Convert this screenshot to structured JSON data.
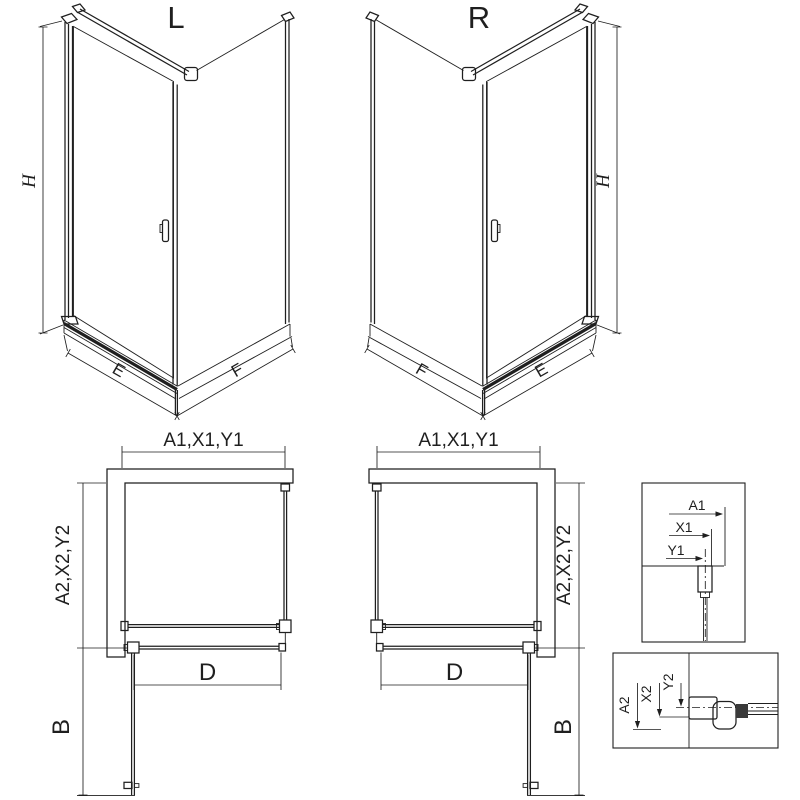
{
  "colors": {
    "ink": "#1f1f1f",
    "background": "#ffffff"
  },
  "views": {
    "iso_left": {
      "label": "L",
      "height_dim": "H",
      "front_dim": "E",
      "side_dim": "F"
    },
    "iso_right": {
      "label": "R",
      "height_dim": "H",
      "front_dim": "E",
      "side_dim": "F"
    },
    "plan_left": {
      "width_dim": "A1,X1,Y1",
      "depth_dim": "A2,X2,Y2",
      "door_dim": "D",
      "swing_dim": "B"
    },
    "plan_right": {
      "width_dim": "A1,X1,Y1",
      "depth_dim": "A2,X2,Y2",
      "door_dim": "D",
      "swing_dim": "B"
    },
    "detail_width": {
      "dims": [
        "A1",
        "X1",
        "Y1"
      ]
    },
    "detail_depth": {
      "dims": [
        "A2",
        "X2",
        "Y2"
      ]
    }
  }
}
